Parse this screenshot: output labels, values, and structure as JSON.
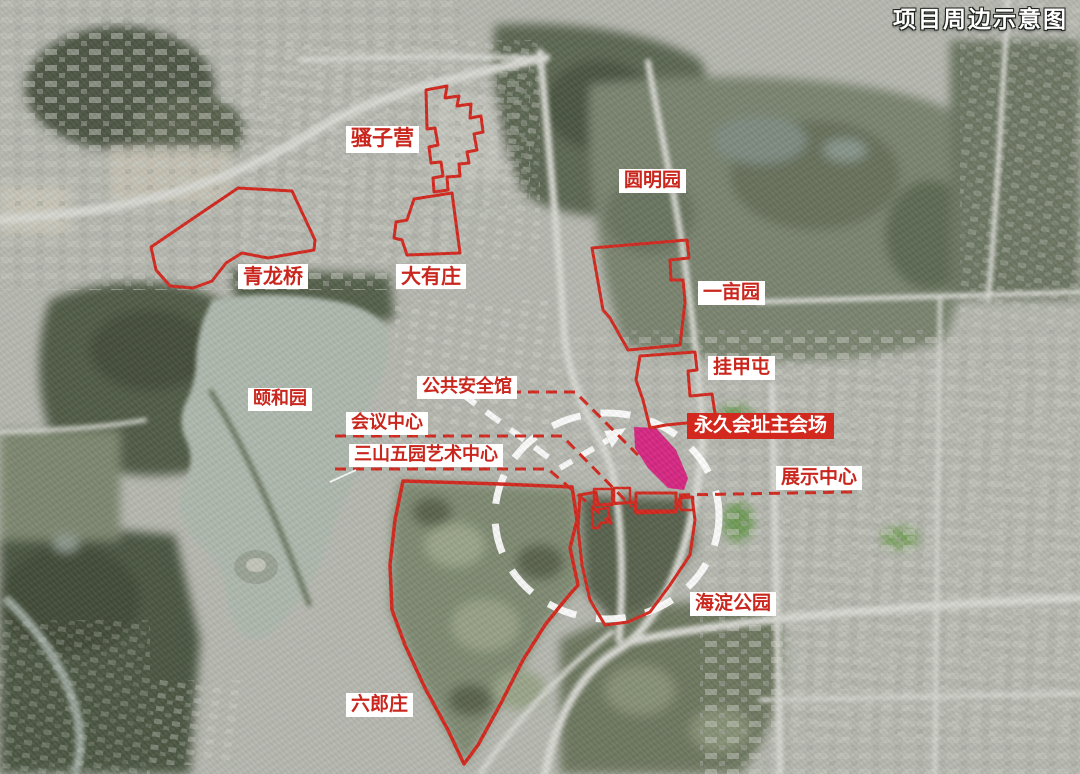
{
  "title": "项目周边示意图",
  "labels": [
    {
      "id": "title",
      "text": "项目周边示意图",
      "style": "map-title"
    },
    {
      "id": "saoziying",
      "text": "骚子营",
      "style": "place"
    },
    {
      "id": "yuanmingyuan",
      "text": "圆明园",
      "style": "place"
    },
    {
      "id": "qinglongqiao",
      "text": "青龙桥",
      "style": "place"
    },
    {
      "id": "dayouzhuang",
      "text": "大有庄",
      "style": "place"
    },
    {
      "id": "yimuyuan",
      "text": "一亩园",
      "style": "place"
    },
    {
      "id": "guajiatun",
      "text": "挂甲屯",
      "style": "place"
    },
    {
      "id": "yiheyuan",
      "text": "颐和园",
      "style": "place"
    },
    {
      "id": "public_safety",
      "text": "公共安全馆",
      "style": "place"
    },
    {
      "id": "conference",
      "text": "会议中心",
      "style": "place-with-leader"
    },
    {
      "id": "art_center",
      "text": "三山五园艺术中心",
      "style": "place-with-leader"
    },
    {
      "id": "main_venue",
      "text": "永久会址主会场",
      "style": "venue-highlight"
    },
    {
      "id": "exhibition",
      "text": "展示中心",
      "style": "place-with-leader"
    },
    {
      "id": "haidian_park",
      "text": "海淀公园",
      "style": "place"
    },
    {
      "id": "liulangzhuang",
      "text": "六郎庄",
      "style": "place"
    }
  ],
  "colors": {
    "boundary_red": "#d2281e",
    "label_text_red": "#c9271d",
    "label_bg_white": "#ffffff",
    "venue_label_bg_red": "#d2281e",
    "venue_site_magenta": "#d61f7e",
    "focus_circle_white": "#ffffff"
  }
}
